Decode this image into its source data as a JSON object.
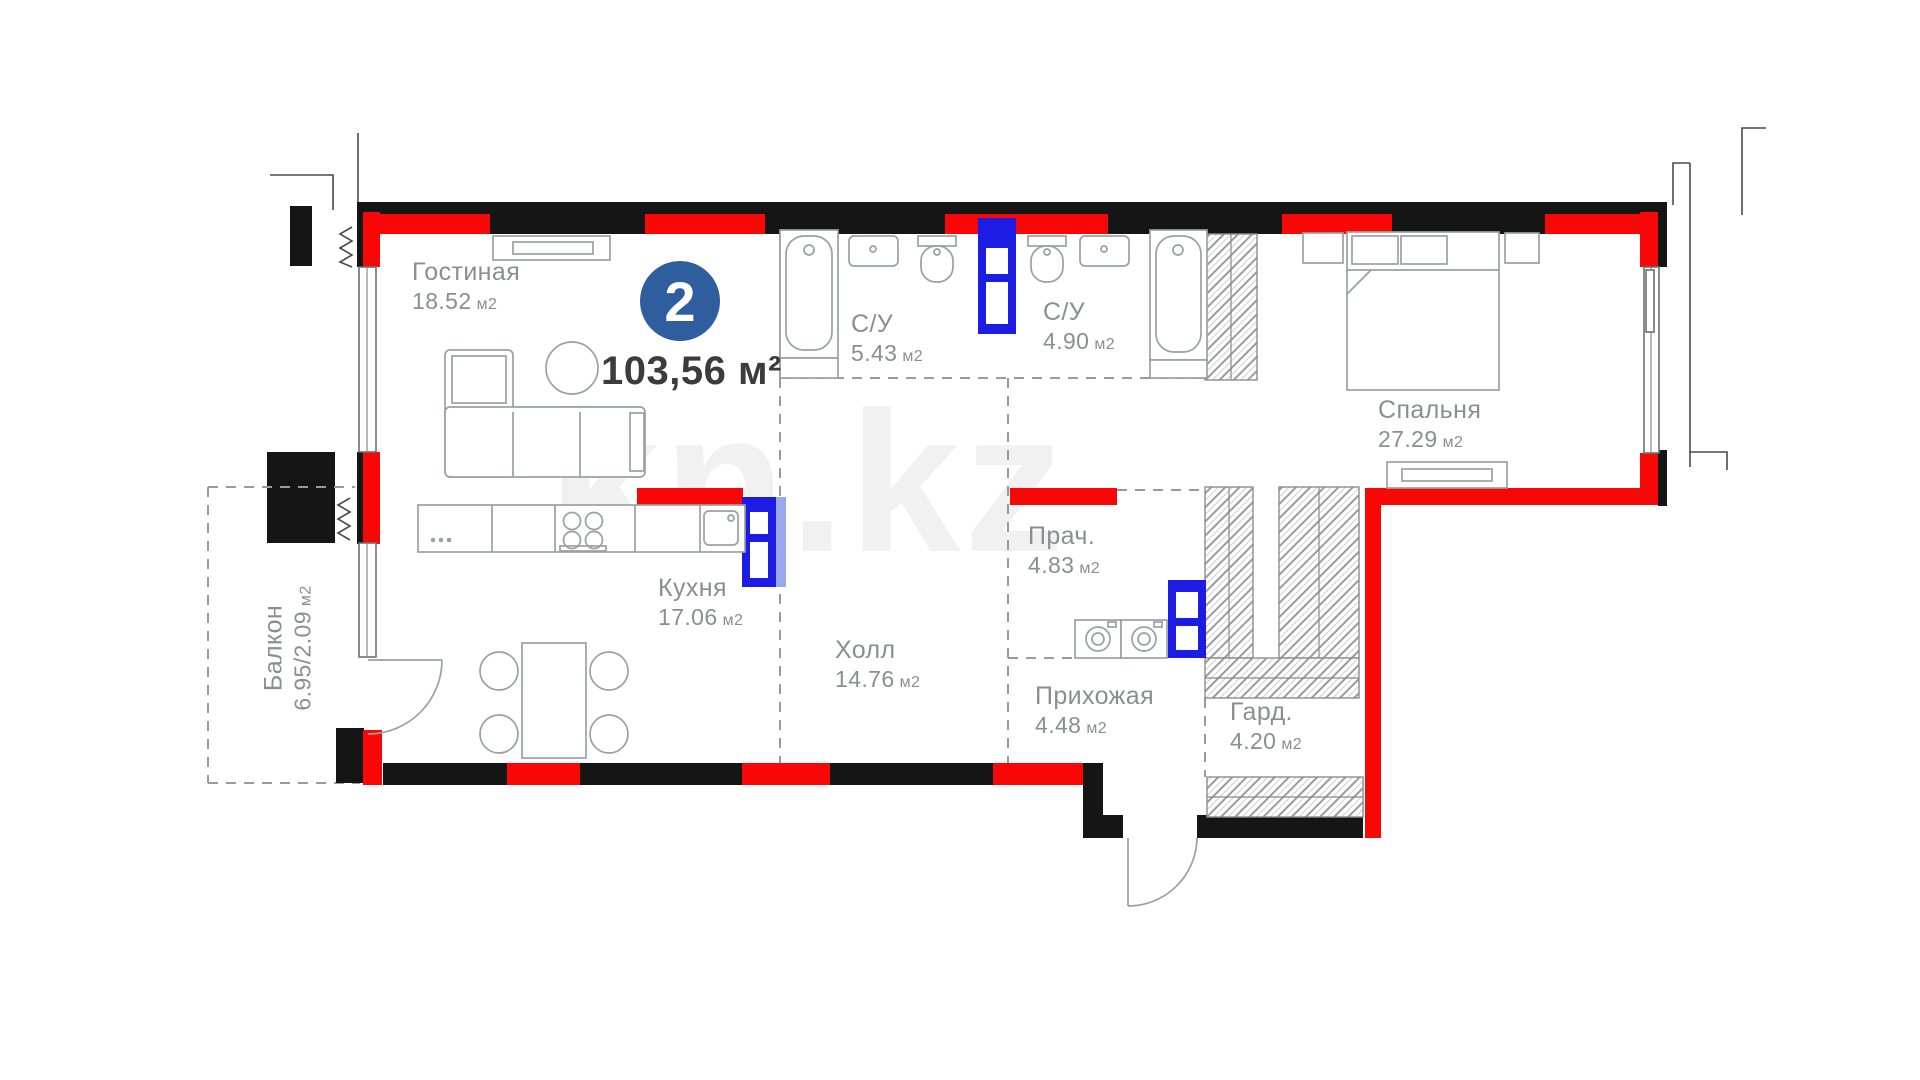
{
  "plan": {
    "unit_number": "2",
    "total_area": "103,56 м²",
    "watermark": "kn.kz"
  },
  "rooms": [
    {
      "id": "living",
      "name": "Гостиная",
      "area": "18.52",
      "unit": "м2"
    },
    {
      "id": "kitchen",
      "name": "Кухня",
      "area": "17.06",
      "unit": "м2"
    },
    {
      "id": "hall",
      "name": "Холл",
      "area": "14.76",
      "unit": "м2"
    },
    {
      "id": "bath1",
      "name": "С/У",
      "area": "5.43",
      "unit": "м2"
    },
    {
      "id": "bath2",
      "name": "С/У",
      "area": "4.90",
      "unit": "м2"
    },
    {
      "id": "bedroom",
      "name": "Спальня",
      "area": "27.29",
      "unit": "м2"
    },
    {
      "id": "laundry",
      "name": "Прач.",
      "area": "4.83",
      "unit": "м2"
    },
    {
      "id": "entry",
      "name": "Прихожая",
      "area": "4.48",
      "unit": "м2"
    },
    {
      "id": "wardrobe",
      "name": "Гард.",
      "area": "4.20",
      "unit": "м2"
    },
    {
      "id": "balcony",
      "name": "Балкон",
      "area": "6.95/2.09",
      "unit": "м2"
    }
  ],
  "colors": {
    "wall_red": "#F90707",
    "wall_black": "#151515",
    "door_blue": "#1C1CE4",
    "door_blue_light": "#9AA8F0",
    "badge_blue": "#2F5E9F",
    "label_gray": "#8B8E91",
    "line_gray": "#9BA0A3"
  }
}
